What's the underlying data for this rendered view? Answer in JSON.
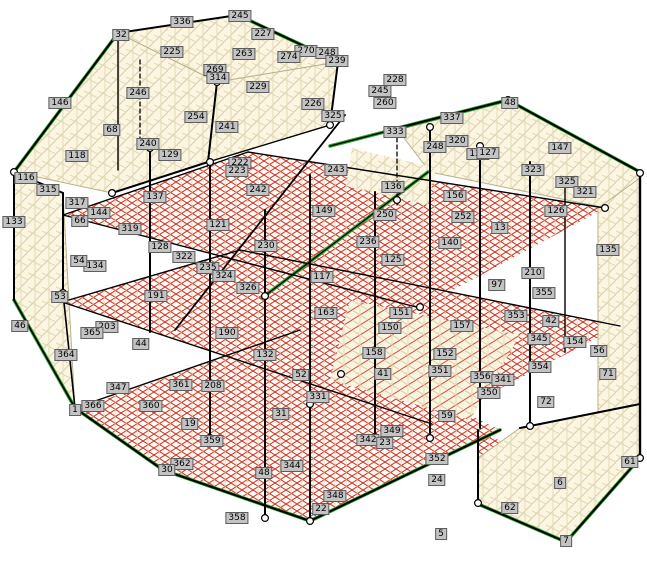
{
  "colors": {
    "background": "#ffffff",
    "wall_fill": "#fbf5e1",
    "wall_grid": "#d8d1a6",
    "floor_grid_red": "#d03028",
    "frame_black": "#000000",
    "edge_green": "#2da12d",
    "label_bg": "#c3c3c3",
    "label_border": "#5e5e5e",
    "node_fill": "#ffffff"
  },
  "model": {
    "labels": [
      {
        "t": "32",
        "x": 121,
        "y": 35
      },
      {
        "t": "336",
        "x": 182,
        "y": 22
      },
      {
        "t": "245",
        "x": 240,
        "y": 16
      },
      {
        "t": "227",
        "x": 263,
        "y": 34
      },
      {
        "t": "225",
        "x": 172,
        "y": 52
      },
      {
        "t": "263",
        "x": 244,
        "y": 54
      },
      {
        "t": "270",
        "x": 306,
        "y": 51
      },
      {
        "t": "248",
        "x": 327,
        "y": 53
      },
      {
        "t": "274",
        "x": 289,
        "y": 57
      },
      {
        "t": "239",
        "x": 337,
        "y": 61
      },
      {
        "t": "269",
        "x": 215,
        "y": 70
      },
      {
        "t": "314",
        "x": 218,
        "y": 78
      },
      {
        "t": "229",
        "x": 258,
        "y": 87
      },
      {
        "t": "228",
        "x": 395,
        "y": 80
      },
      {
        "t": "245",
        "x": 380,
        "y": 91
      },
      {
        "t": "260",
        "x": 385,
        "y": 103
      },
      {
        "t": "226",
        "x": 313,
        "y": 104
      },
      {
        "t": "246",
        "x": 138,
        "y": 93
      },
      {
        "t": "146",
        "x": 60,
        "y": 103
      },
      {
        "t": "68",
        "x": 112,
        "y": 130
      },
      {
        "t": "325",
        "x": 333,
        "y": 116
      },
      {
        "t": "337",
        "x": 452,
        "y": 118
      },
      {
        "t": "333",
        "x": 395,
        "y": 132
      },
      {
        "t": "320",
        "x": 457,
        "y": 141
      },
      {
        "t": "248",
        "x": 435,
        "y": 147
      },
      {
        "t": "240",
        "x": 148,
        "y": 144
      },
      {
        "t": "241",
        "x": 227,
        "y": 127
      },
      {
        "t": "254",
        "x": 196,
        "y": 117
      },
      {
        "t": "48",
        "x": 510,
        "y": 103
      },
      {
        "t": "147",
        "x": 560,
        "y": 148
      },
      {
        "t": "118",
        "x": 77,
        "y": 156
      },
      {
        "t": "116",
        "x": 26,
        "y": 178
      },
      {
        "t": "315",
        "x": 48,
        "y": 190
      },
      {
        "t": "317",
        "x": 77,
        "y": 203
      },
      {
        "t": "144",
        "x": 99,
        "y": 213
      },
      {
        "t": "133",
        "x": 14,
        "y": 222
      },
      {
        "t": "66",
        "x": 80,
        "y": 221
      },
      {
        "t": "319",
        "x": 130,
        "y": 229
      },
      {
        "t": "137",
        "x": 155,
        "y": 197
      },
      {
        "t": "129",
        "x": 170,
        "y": 155
      },
      {
        "t": "222",
        "x": 240,
        "y": 163
      },
      {
        "t": "223",
        "x": 237,
        "y": 171
      },
      {
        "t": "242",
        "x": 258,
        "y": 190
      },
      {
        "t": "243",
        "x": 336,
        "y": 170
      },
      {
        "t": "136",
        "x": 393,
        "y": 187
      },
      {
        "t": "149",
        "x": 324,
        "y": 211
      },
      {
        "t": "121",
        "x": 218,
        "y": 225
      },
      {
        "t": "230",
        "x": 266,
        "y": 246
      },
      {
        "t": "128",
        "x": 160,
        "y": 247
      },
      {
        "t": "322",
        "x": 184,
        "y": 257
      },
      {
        "t": "235",
        "x": 208,
        "y": 268
      },
      {
        "t": "324",
        "x": 224,
        "y": 276
      },
      {
        "t": "326",
        "x": 248,
        "y": 288
      },
      {
        "t": "117",
        "x": 322,
        "y": 277
      },
      {
        "t": "134",
        "x": 95,
        "y": 266
      },
      {
        "t": "54",
        "x": 79,
        "y": 261
      },
      {
        "t": "191",
        "x": 156,
        "y": 296
      },
      {
        "t": "250",
        "x": 385,
        "y": 215
      },
      {
        "t": "252",
        "x": 463,
        "y": 217
      },
      {
        "t": "236",
        "x": 368,
        "y": 242
      },
      {
        "t": "140",
        "x": 450,
        "y": 243
      },
      {
        "t": "125",
        "x": 393,
        "y": 260
      },
      {
        "t": "156",
        "x": 455,
        "y": 196
      },
      {
        "t": "124",
        "x": 478,
        "y": 154
      },
      {
        "t": "13",
        "x": 500,
        "y": 228
      },
      {
        "t": "127",
        "x": 488,
        "y": 153
      },
      {
        "t": "323",
        "x": 533,
        "y": 170
      },
      {
        "t": "325",
        "x": 567,
        "y": 182
      },
      {
        "t": "321",
        "x": 585,
        "y": 192
      },
      {
        "t": "126",
        "x": 556,
        "y": 211
      },
      {
        "t": "135",
        "x": 608,
        "y": 250
      },
      {
        "t": "210",
        "x": 533,
        "y": 273
      },
      {
        "t": "97",
        "x": 497,
        "y": 285
      },
      {
        "t": "46",
        "x": 20,
        "y": 326
      },
      {
        "t": "53",
        "x": 60,
        "y": 297
      },
      {
        "t": "203",
        "x": 107,
        "y": 327
      },
      {
        "t": "365",
        "x": 92,
        "y": 333
      },
      {
        "t": "364",
        "x": 66,
        "y": 355
      },
      {
        "t": "44",
        "x": 141,
        "y": 344
      },
      {
        "t": "347",
        "x": 118,
        "y": 388
      },
      {
        "t": "366",
        "x": 93,
        "y": 406
      },
      {
        "t": "1",
        "x": 75,
        "y": 410
      },
      {
        "t": "360",
        "x": 151,
        "y": 406
      },
      {
        "t": "190",
        "x": 227,
        "y": 333
      },
      {
        "t": "132",
        "x": 265,
        "y": 355
      },
      {
        "t": "361",
        "x": 181,
        "y": 385
      },
      {
        "t": "208",
        "x": 213,
        "y": 386
      },
      {
        "t": "19",
        "x": 190,
        "y": 424
      },
      {
        "t": "52",
        "x": 301,
        "y": 375
      },
      {
        "t": "163",
        "x": 326,
        "y": 313
      },
      {
        "t": "151",
        "x": 401,
        "y": 313
      },
      {
        "t": "157",
        "x": 462,
        "y": 326
      },
      {
        "t": "150",
        "x": 390,
        "y": 328
      },
      {
        "t": "158",
        "x": 374,
        "y": 353
      },
      {
        "t": "152",
        "x": 445,
        "y": 354
      },
      {
        "t": "351",
        "x": 440,
        "y": 371
      },
      {
        "t": "41",
        "x": 383,
        "y": 374
      },
      {
        "t": "331",
        "x": 318,
        "y": 397
      },
      {
        "t": "31",
        "x": 281,
        "y": 414
      },
      {
        "t": "59",
        "x": 447,
        "y": 416
      },
      {
        "t": "356",
        "x": 482,
        "y": 377
      },
      {
        "t": "355",
        "x": 544,
        "y": 293
      },
      {
        "t": "353",
        "x": 516,
        "y": 316
      },
      {
        "t": "42",
        "x": 551,
        "y": 321
      },
      {
        "t": "345",
        "x": 539,
        "y": 339
      },
      {
        "t": "341",
        "x": 503,
        "y": 380
      },
      {
        "t": "350",
        "x": 489,
        "y": 393
      },
      {
        "t": "154",
        "x": 575,
        "y": 342
      },
      {
        "t": "56",
        "x": 599,
        "y": 351
      },
      {
        "t": "354",
        "x": 540,
        "y": 367
      },
      {
        "t": "71",
        "x": 608,
        "y": 374
      },
      {
        "t": "72",
        "x": 546,
        "y": 402
      },
      {
        "t": "359",
        "x": 212,
        "y": 441
      },
      {
        "t": "362",
        "x": 182,
        "y": 464
      },
      {
        "t": "30",
        "x": 167,
        "y": 470
      },
      {
        "t": "344",
        "x": 292,
        "y": 466
      },
      {
        "t": "48",
        "x": 264,
        "y": 473
      },
      {
        "t": "358",
        "x": 237,
        "y": 518
      },
      {
        "t": "22",
        "x": 321,
        "y": 509
      },
      {
        "t": "349",
        "x": 392,
        "y": 431
      },
      {
        "t": "342",
        "x": 368,
        "y": 440
      },
      {
        "t": "23",
        "x": 385,
        "y": 443
      },
      {
        "t": "352",
        "x": 437,
        "y": 459
      },
      {
        "t": "24",
        "x": 437,
        "y": 480
      },
      {
        "t": "348",
        "x": 335,
        "y": 496
      },
      {
        "t": "5",
        "x": 441,
        "y": 534
      },
      {
        "t": "61",
        "x": 630,
        "y": 462
      },
      {
        "t": "6",
        "x": 560,
        "y": 483
      },
      {
        "t": "62",
        "x": 510,
        "y": 508
      },
      {
        "t": "7",
        "x": 566,
        "y": 541
      }
    ]
  }
}
